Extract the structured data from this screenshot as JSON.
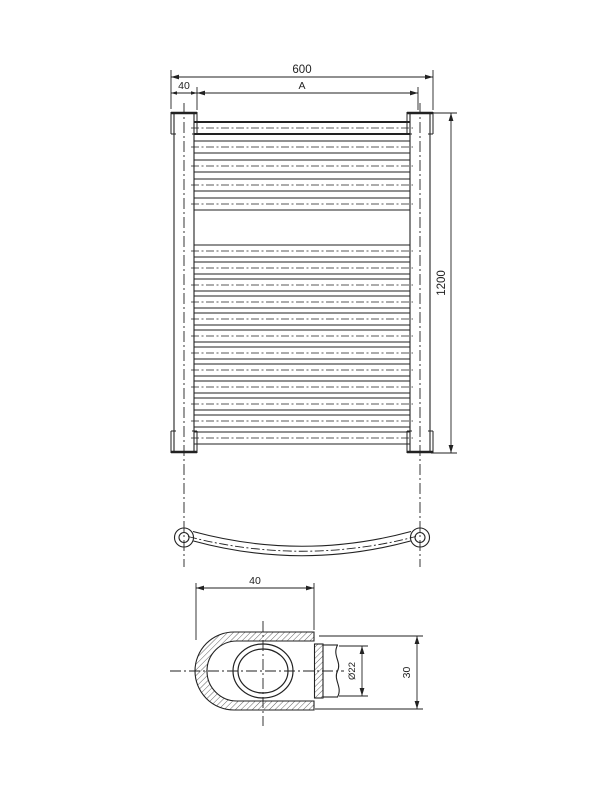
{
  "drawing": {
    "type": "technical-drawing-towel-radiator",
    "front_view": {
      "width_label": "600",
      "tube_width_label": "40",
      "span_label": "A",
      "height_label": "1200"
    },
    "detail_view": {
      "width_label": "40",
      "pipe_diameter_label": "Ø22",
      "depth_label": "30"
    },
    "colors": {
      "line": "#222222",
      "background": "#ffffff"
    }
  }
}
